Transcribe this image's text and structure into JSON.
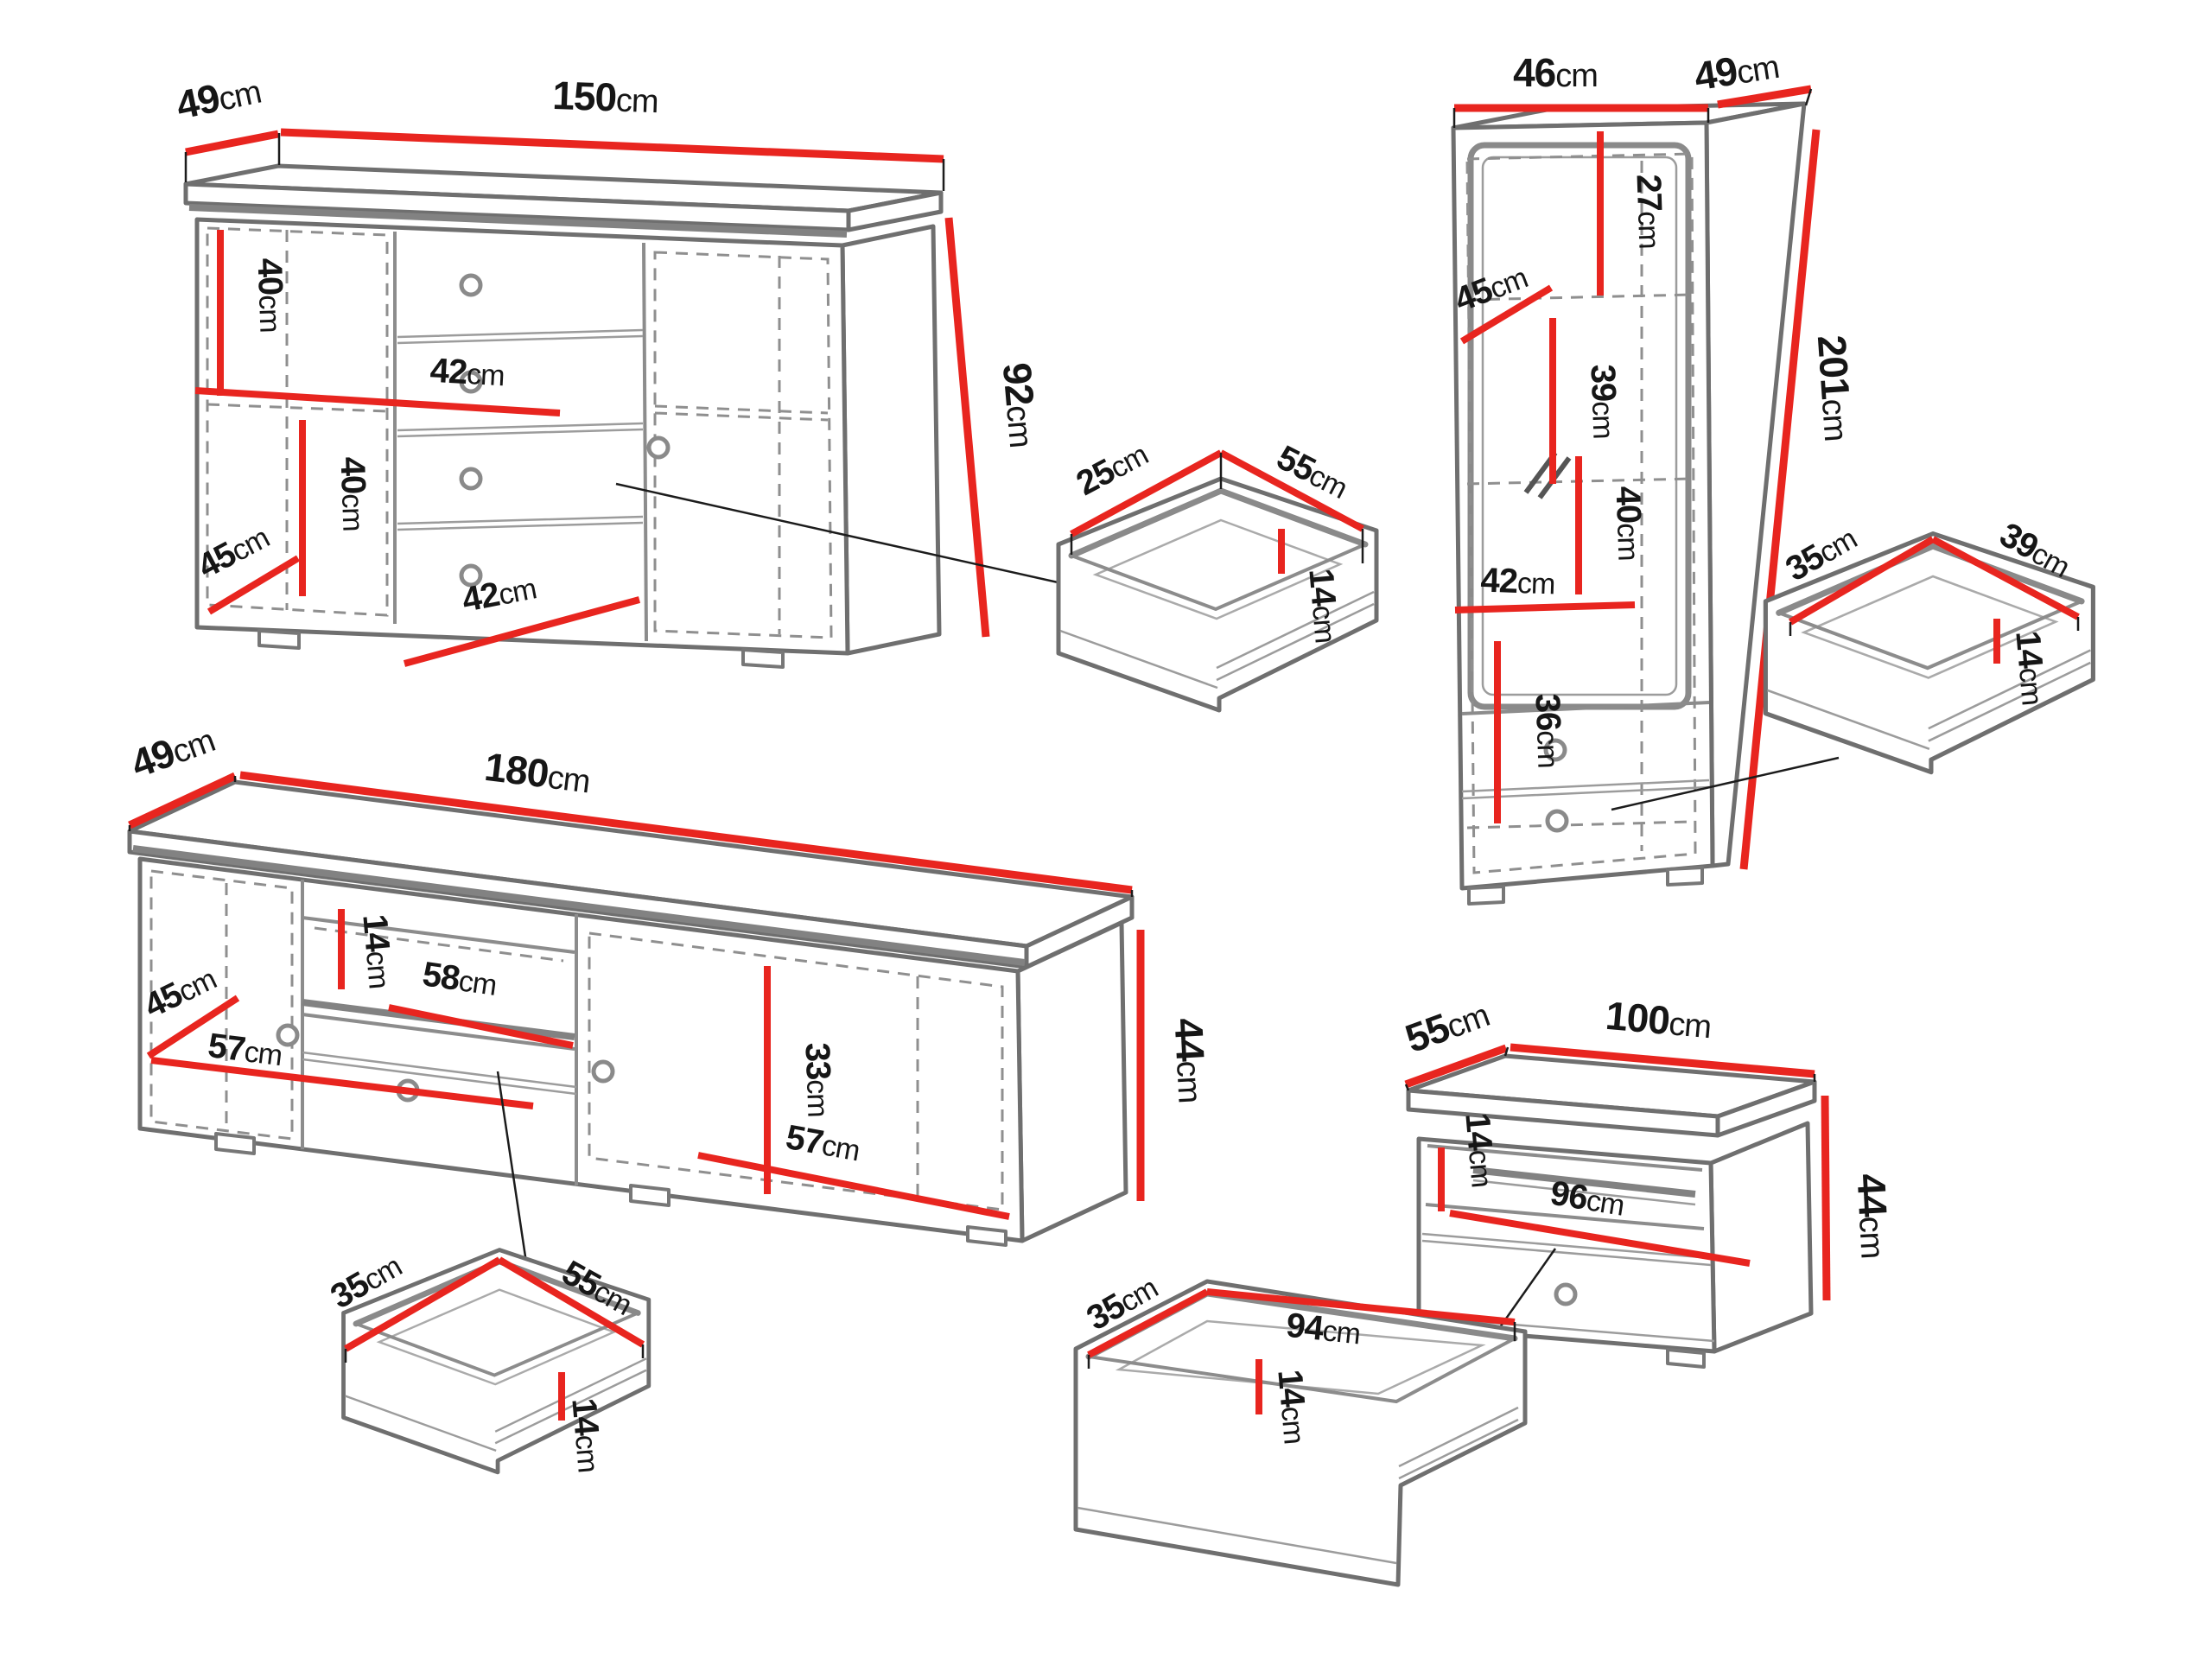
{
  "title": "Furniture set dimension diagram",
  "colors": {
    "dimension_line": "#e8251f",
    "outline_gray": "#8a8a8a",
    "label_black": "#161616"
  },
  "sideboard": {
    "depth": {
      "num": "49",
      "unit": "cm"
    },
    "width": {
      "num": "150",
      "unit": "cm"
    },
    "height": {
      "num": "92",
      "unit": "cm"
    },
    "top_section": {
      "num": "40",
      "unit": "cm"
    },
    "shelf_width": {
      "num": "42",
      "unit": "cm"
    },
    "mid_section": {
      "num": "40",
      "unit": "cm"
    },
    "inner_depth": {
      "num": "45",
      "unit": "cm"
    },
    "bottom_width": {
      "num": "42",
      "unit": "cm"
    }
  },
  "drawer_top": {
    "depth": {
      "num": "25",
      "unit": "cm"
    },
    "width": {
      "num": "55",
      "unit": "cm"
    },
    "height": {
      "num": "14",
      "unit": "cm"
    }
  },
  "tall_cabinet": {
    "width": {
      "num": "46",
      "unit": "cm"
    },
    "depth": {
      "num": "49",
      "unit": "cm"
    },
    "height": {
      "num": "201",
      "unit": "cm"
    },
    "top_section": {
      "num": "27",
      "unit": "cm"
    },
    "inner_depth": {
      "num": "45",
      "unit": "cm"
    },
    "upper_section": {
      "num": "39",
      "unit": "cm"
    },
    "mid_section": {
      "num": "40",
      "unit": "cm"
    },
    "inner_width": {
      "num": "42",
      "unit": "cm"
    },
    "lower_section": {
      "num": "36",
      "unit": "cm"
    }
  },
  "drawer_right": {
    "depth": {
      "num": "35",
      "unit": "cm"
    },
    "width": {
      "num": "39",
      "unit": "cm"
    },
    "height": {
      "num": "14",
      "unit": "cm"
    }
  },
  "tv_stand": {
    "depth": {
      "num": "49",
      "unit": "cm"
    },
    "width": {
      "num": "180",
      "unit": "cm"
    },
    "height": {
      "num": "44",
      "unit": "cm"
    },
    "inner_depth": {
      "num": "45",
      "unit": "cm"
    },
    "left_width": {
      "num": "57",
      "unit": "cm"
    },
    "niche_height": {
      "num": "14",
      "unit": "cm"
    },
    "niche_width": {
      "num": "58",
      "unit": "cm"
    },
    "right_height": {
      "num": "33",
      "unit": "cm"
    },
    "right_width": {
      "num": "57",
      "unit": "cm"
    }
  },
  "drawer_bottom_left": {
    "depth": {
      "num": "35",
      "unit": "cm"
    },
    "width": {
      "num": "55",
      "unit": "cm"
    },
    "height": {
      "num": "14",
      "unit": "cm"
    }
  },
  "drawer_bottom_mid": {
    "depth": {
      "num": "35",
      "unit": "cm"
    },
    "width": {
      "num": "94",
      "unit": "cm"
    },
    "height": {
      "num": "14",
      "unit": "cm"
    }
  },
  "tv_cabinet": {
    "depth": {
      "num": "55",
      "unit": "cm"
    },
    "width": {
      "num": "100",
      "unit": "cm"
    },
    "height": {
      "num": "44",
      "unit": "cm"
    },
    "niche_height": {
      "num": "14",
      "unit": "cm"
    },
    "niche_width": {
      "num": "96",
      "unit": "cm"
    }
  }
}
